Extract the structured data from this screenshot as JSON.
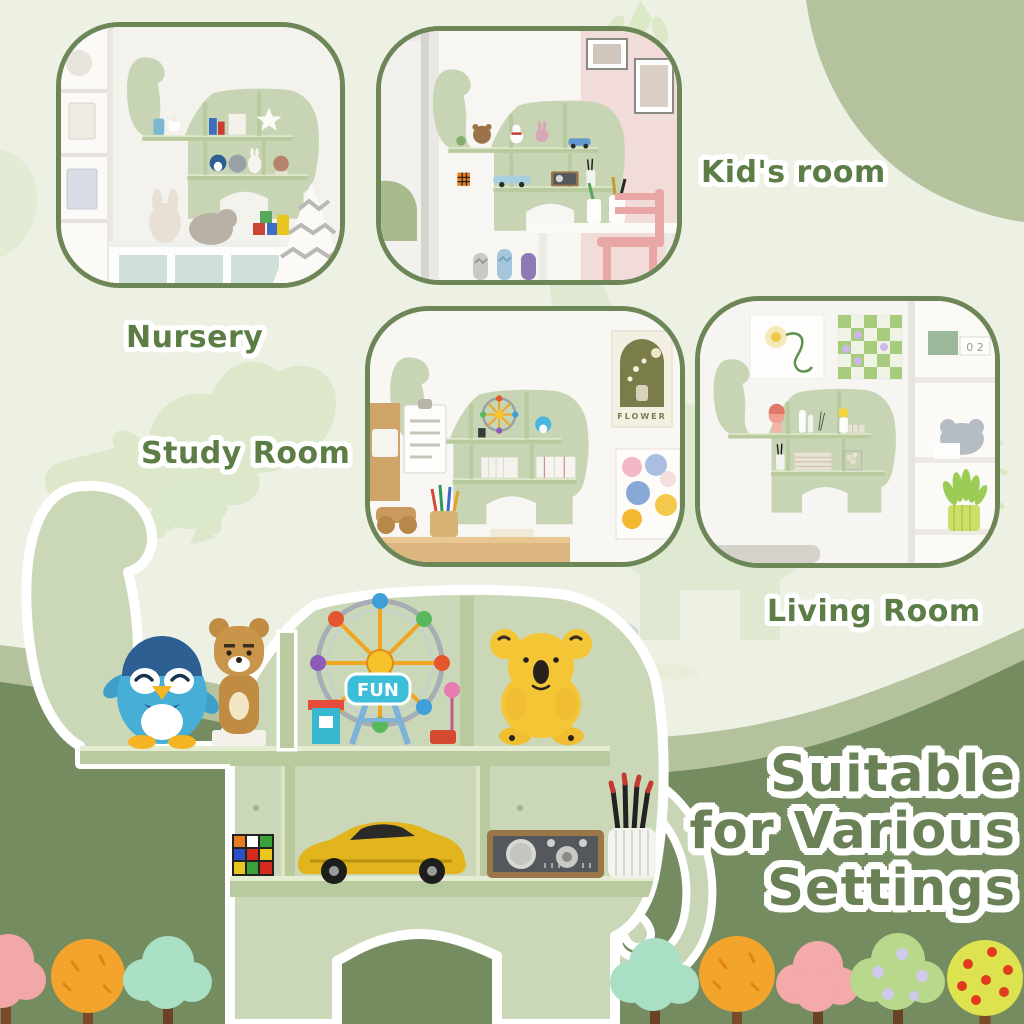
{
  "labels": {
    "nursery": "Nursery",
    "kids_room": "Kid's room",
    "study_room": "Study Room",
    "living_room": "Living Room"
  },
  "headline": {
    "line1": "Suitable",
    "line2": "for Various",
    "line3": "Settings"
  },
  "decorations": {
    "lego_sign": "FUN",
    "poster_title": "FLOWER",
    "calendar_cubes": "0 2"
  },
  "colors": {
    "background": "#edf1e3",
    "sage_band": "#b4c39e",
    "dark_green_band": "#758b60",
    "photo_border": "#6d8657",
    "label_green": "#5c7d45",
    "headline_green": "#6a8156",
    "shelf_green": "#cbd8b8",
    "shelf_board": "#b9cb9e",
    "outline_white": "#ffffff"
  },
  "trees": [
    {
      "shape": "cloud",
      "color": "#f2a7a9"
    },
    {
      "shape": "round",
      "color": "#f2a42c"
    },
    {
      "shape": "cloud",
      "color": "#a9dfc5"
    },
    {
      "shape": "cloud",
      "color": "#a9dfc5"
    },
    {
      "shape": "round",
      "color": "#f2a42c"
    },
    {
      "shape": "cloud",
      "color": "#f4a9ab"
    },
    {
      "shape": "cloud-dotted",
      "color": "#b8d98b",
      "dot_color": "#cfc9ea"
    },
    {
      "shape": "round-dotted",
      "color": "#dde24f",
      "dot_color": "#e23a1f"
    }
  ]
}
